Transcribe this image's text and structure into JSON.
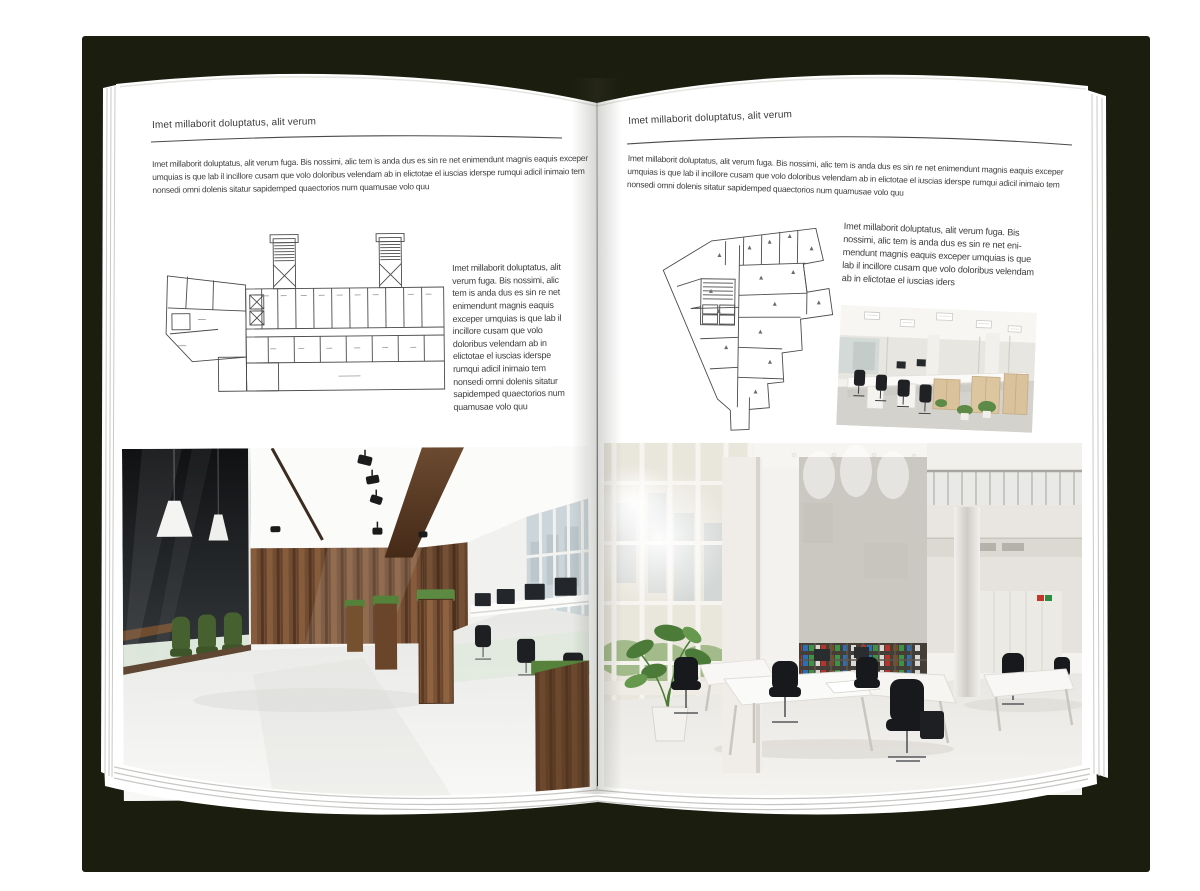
{
  "canvas": {
    "backdrop_color": "#1b1d0e",
    "page_color": "#ffffff"
  },
  "left_page": {
    "header": "Imet millaborit doluptatus, alit verum",
    "intro": "Imet millaborit doluptatus, alit verum fuga. Bis nossimi, alic tem is anda dus es sin re net enimendunt magnis eaquis exceper umquias is que lab il incillore cusam que volo doloribus velendam ab in elictotae el iuscias iderspe rumqui adicil inimaio tem nonsedi omni dolenis sitatur sapidemped quaectorios num quamusae volo quu",
    "caption": "Imet millaborit doluptatus, alit verum fuga. Bis nossimi, alic tem is anda dus es sin re net enimendunt magnis eaquis exceper umquias is que lab il incillore cusam que volo doloribus velendam ab in elictotae el iuscias iderspe rumqui adicil inimaio tem nonsedi omni dolenis sitatur sapidemped quaectorios num quamusae volo quu",
    "figures": {
      "floor_plan": "architectural floor plan drawing",
      "photo": "office interior with glass meeting room, wooden wall and desks"
    }
  },
  "right_page": {
    "header": "Imet millaborit doluptatus, alit verum",
    "intro": "Imet millaborit doluptatus, alit verum fuga. Bis nossimi, alic tem is anda dus es sin re net enimendunt magnis eaquis exceper umquias is que lab il incillore cusam que volo doloribus velendam ab in elictotae el iuscias iderspe rumqui adicil inimaio tem nonsedi omni dolenis sitatur sapidemped quaectorios num quamusae volo quu",
    "caption": "Imet millaborit doluptatus, alit verum fuga. Bis nossimi, alic tem is anda dus es sin re net eni-mendunt magnis eaquis exceper umquias is que lab il incillore cusam que volo doloribus velendam ab in elictotae el iuscias iders",
    "figures": {
      "floor_plan": "irregular architectural floor plan drawing",
      "photo_small": "open-plan office with rows of desks",
      "photo_large": "two-storey white office atrium with bookshelf and plant"
    }
  }
}
